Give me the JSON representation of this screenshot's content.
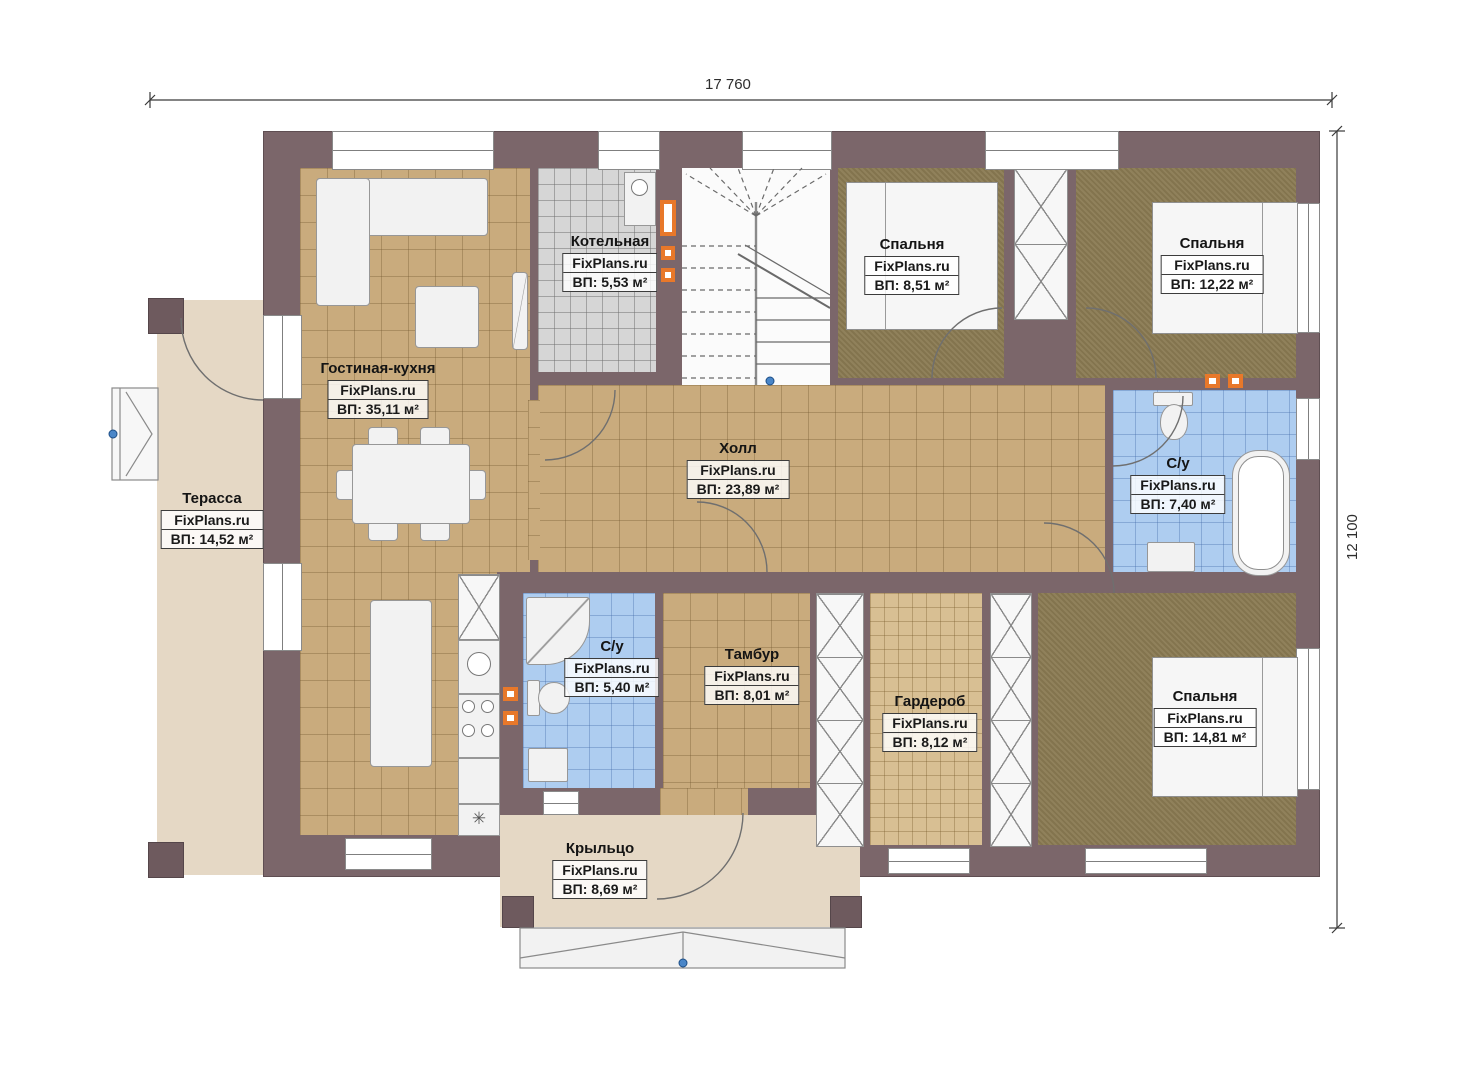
{
  "meta": {
    "watermark": "FixPlans.ru",
    "plan_type": "floor-plan"
  },
  "dims": {
    "top": "17 760",
    "right": "12 100"
  },
  "rooms": [
    {
      "id": "terrace",
      "name": "Терасса",
      "area": "ВП: 14,52 м²"
    },
    {
      "id": "living-kitchen",
      "name": "Гостиная-кухня",
      "area": "ВП: 35,11 м²"
    },
    {
      "id": "boiler",
      "name": "Котельная",
      "area": "ВП: 5,53 м²"
    },
    {
      "id": "bedroom-1",
      "name": "Спальня",
      "area": "ВП: 8,51 м²"
    },
    {
      "id": "bedroom-2",
      "name": "Спальня",
      "area": "ВП: 12,22 м²"
    },
    {
      "id": "hall",
      "name": "Холл",
      "area": "ВП: 23,89 м²"
    },
    {
      "id": "bathroom-1",
      "name": "С/у",
      "area": "ВП: 7,40 м²"
    },
    {
      "id": "bathroom-2",
      "name": "С/у",
      "area": "ВП: 5,40 м²"
    },
    {
      "id": "vestibule",
      "name": "Тамбур",
      "area": "ВП: 8,01 м²"
    },
    {
      "id": "wardrobe",
      "name": "Гардероб",
      "area": "ВП: 8,12 м²"
    },
    {
      "id": "bedroom-3",
      "name": "Спальня",
      "area": "ВП: 14,81 м²"
    },
    {
      "id": "porch",
      "name": "Крыльцо",
      "area": "ВП: 8,69 м²"
    }
  ],
  "colors": {
    "wall": "#7b666a",
    "tile_tan": "#c9ab7d",
    "tile_blue": "#aecdf0",
    "tile_gray": "#d6d6d6",
    "carpet_olive": "#8a7a52",
    "deck_beige": "#e5d8c5",
    "accent_orange": "#e8782a",
    "marker_blue": "#4a86c8"
  },
  "symbols": {
    "star_cell": "✳"
  }
}
